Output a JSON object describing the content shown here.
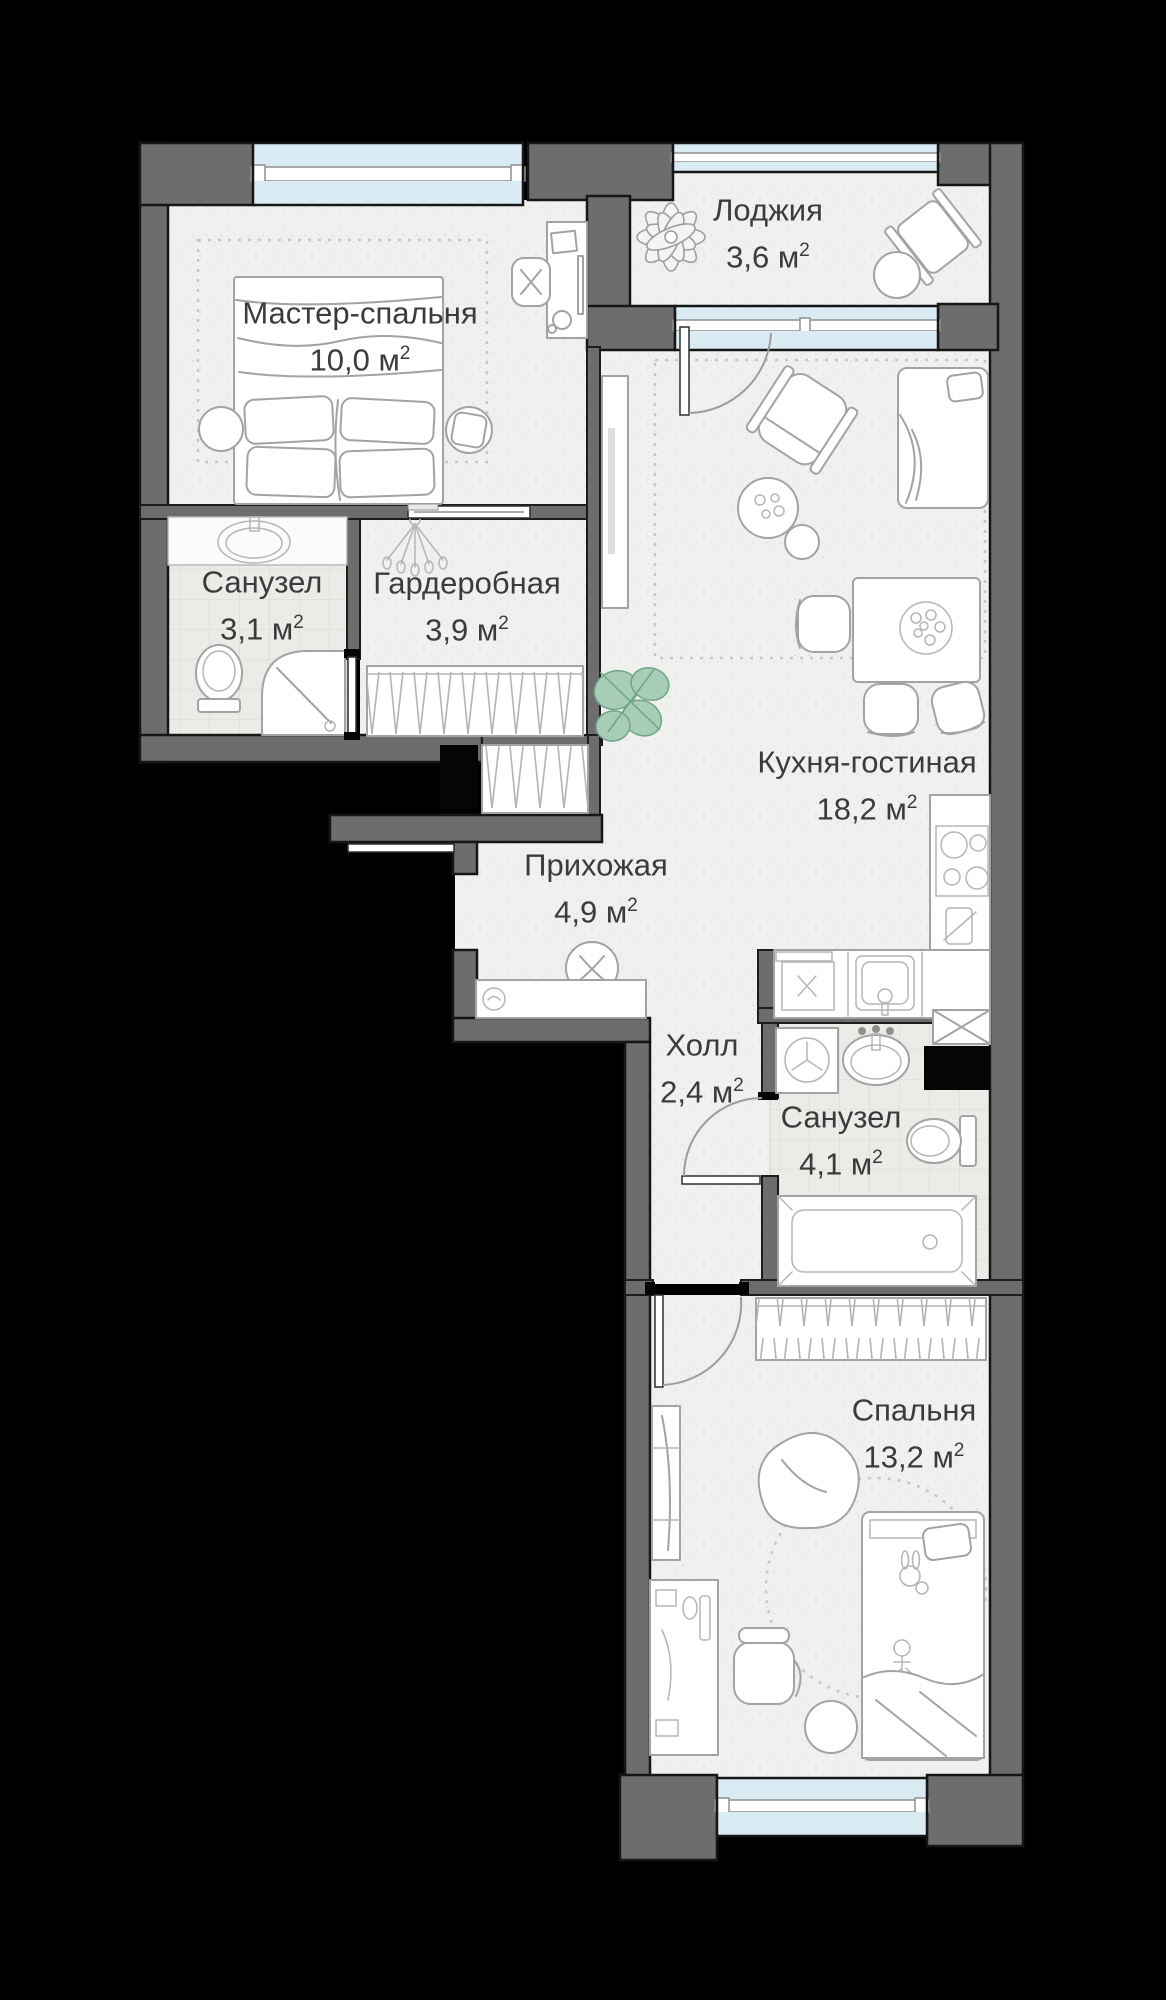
{
  "plan": {
    "type": "apartment-floor-plan",
    "rooms": [
      {
        "id": "master-bedroom",
        "name": "Мастер-спальня",
        "area": "10,0 м²",
        "cx": 360,
        "cy": 337
      },
      {
        "id": "loggia",
        "name": "Лоджия",
        "area": "3,6 м²",
        "cx": 768,
        "cy": 234
      },
      {
        "id": "bathroom-1",
        "name": "Санузел",
        "area": "3,1 м²",
        "cx": 262,
        "cy": 606
      },
      {
        "id": "wardrobe",
        "name": "Гардеробная",
        "area": "3,9 м²",
        "cx": 467,
        "cy": 607
      },
      {
        "id": "kitchen-living",
        "name": "Кухня-гостиная",
        "area": "18,2 м²",
        "cx": 867,
        "cy": 786
      },
      {
        "id": "hallway",
        "name": "Прихожая",
        "area": "4,9 м²",
        "cx": 596,
        "cy": 889
      },
      {
        "id": "hall",
        "name": "Холл",
        "area": "2,4 м²",
        "cx": 702,
        "cy": 1069
      },
      {
        "id": "bathroom-2",
        "name": "Санузел",
        "area": "4,1 м²",
        "cx": 841,
        "cy": 1141
      },
      {
        "id": "bedroom",
        "name": "Спальня",
        "area": "13,2 м²",
        "cx": 914,
        "cy": 1434
      }
    ],
    "colors": {
      "background": "#000000",
      "wall": "#6d6d6d",
      "floor": "#f0f0ee",
      "tile": "#ecebe8",
      "window_glass": "#d9ecf4",
      "furniture_line": "#a3a3a3",
      "plant_green": "#a8cdb6",
      "label_text": "#3b3b3b"
    },
    "furniture_icons": [
      "double-bed",
      "desk",
      "office-chair",
      "stool",
      "monstera-plant",
      "loggia-plant",
      "lounge-chair",
      "round-table",
      "tv-console",
      "sofa-bed",
      "armchair",
      "coffee-table",
      "dining-table",
      "dining-chair",
      "kitchen-stove",
      "kitchen-sink",
      "counter",
      "washing-machine",
      "bathroom-sink",
      "toilet",
      "shower",
      "bathtub",
      "wardrobe-rack",
      "hanging-clothes",
      "pouf",
      "shoe-bench",
      "bean-bag",
      "ball",
      "crib",
      "mirror",
      "rug"
    ]
  }
}
